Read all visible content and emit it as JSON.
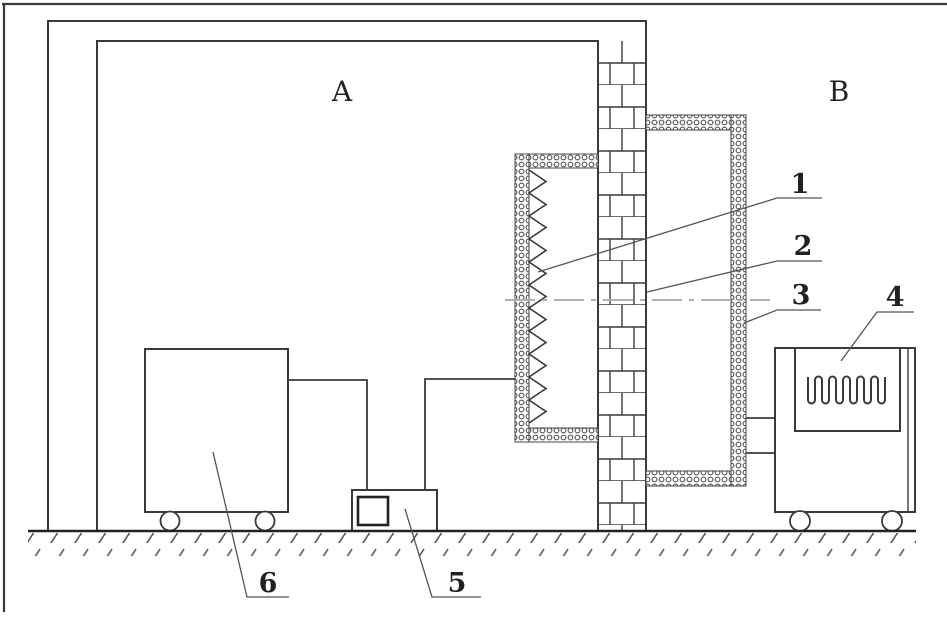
{
  "figure": {
    "background": "#ffffff",
    "ink": "#3a3a3a",
    "thin_line": "#555555",
    "centerline_color": "#b0b0b0",
    "zones": {
      "a": "A",
      "b": "B"
    },
    "callouts": {
      "n1": "1",
      "n2": "2",
      "n3": "3",
      "n4": "4",
      "n5": "5",
      "n6": "6"
    }
  }
}
